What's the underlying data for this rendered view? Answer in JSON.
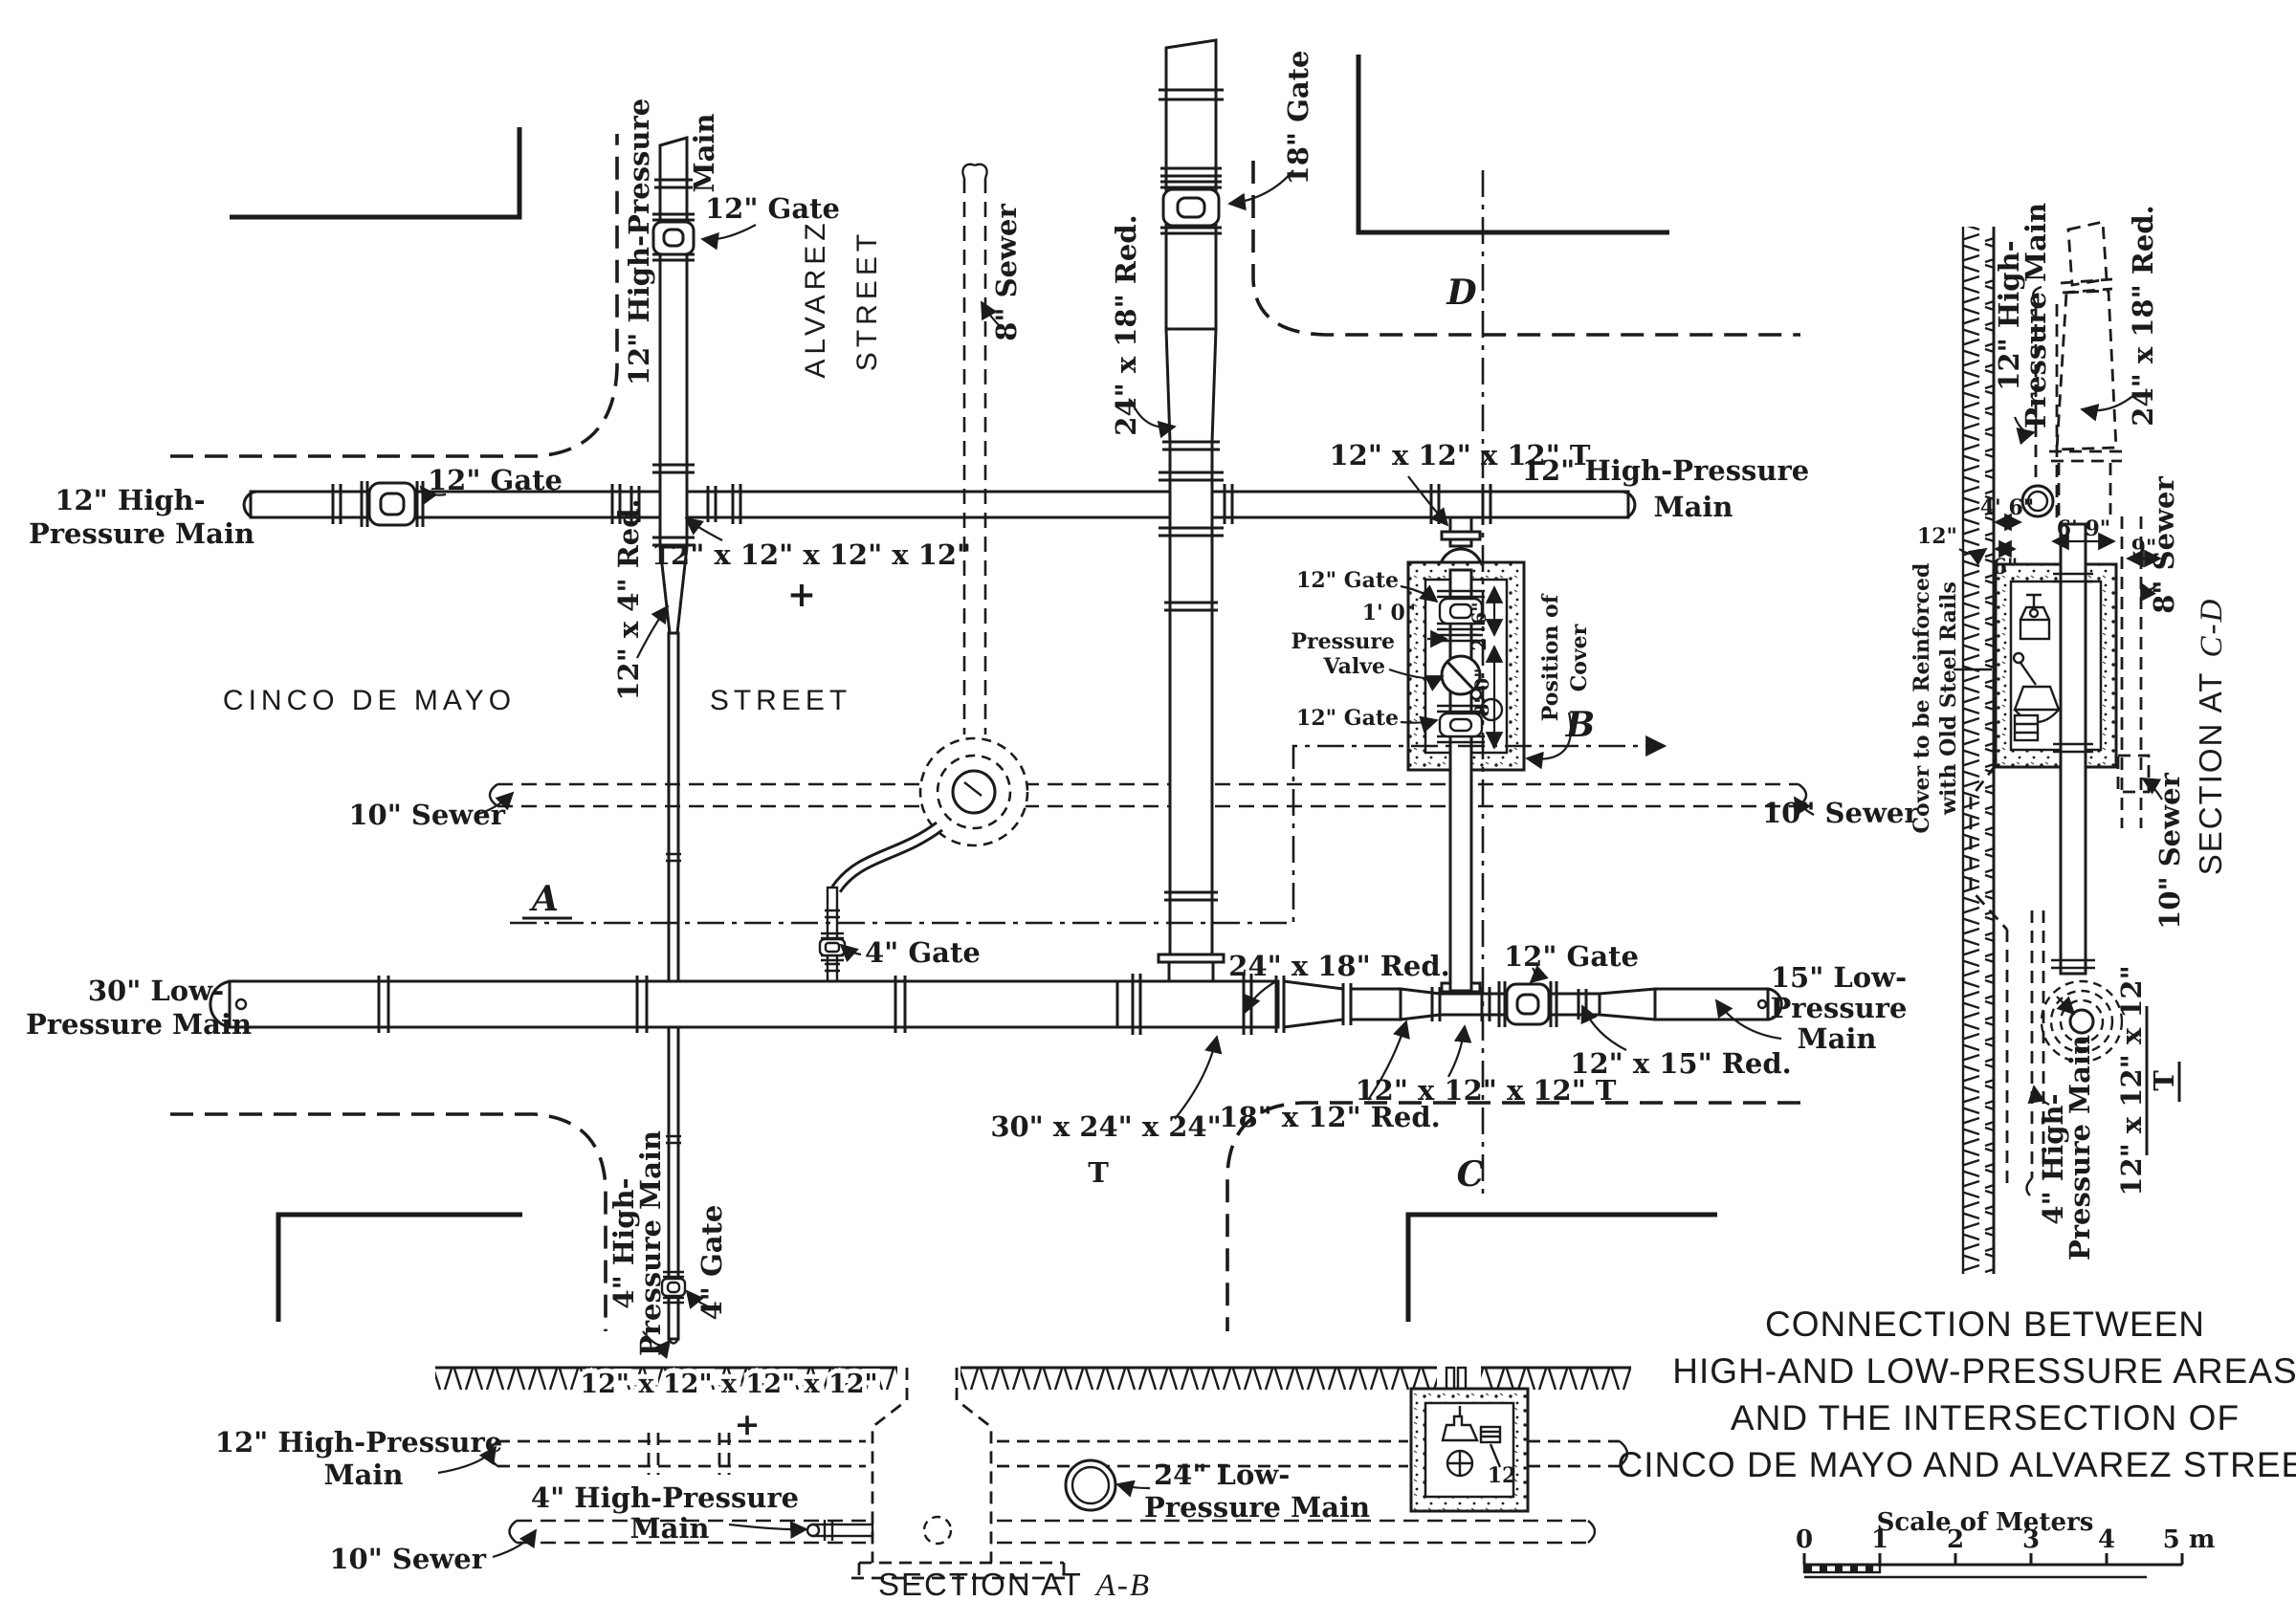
{
  "ink": "#1b1b1b",
  "paper": "#ffffff",
  "plan": {
    "streets": {
      "cinco_de_mayo": "CINCO DE MAYO",
      "street_h": "STREET",
      "alvarez": "ALVAREZ",
      "street_v": "STREET"
    },
    "labels": {
      "hp12_alvarez_1": "12\" High-Pressure",
      "hp12_alvarez_2": "Main",
      "gate12_top": "12\" Gate",
      "sewer8": "8\" Sewer",
      "gate18": "18\" Gate",
      "red24x18_top": "24\" x 18\" Red.",
      "tee12_top": "12\" x 12\" x 12\" T",
      "hp12_right_1": "12\" High-Pressure",
      "hp12_right_2": "Main",
      "hp12_left_1": "12\" High-",
      "hp12_left_2": "Pressure Main",
      "gate12_left": "12\" Gate",
      "cross12": "12\" x 12\" x 12\" x 12\"",
      "cross12_plus": "+",
      "red12x4": "12\" x 4\" Red.",
      "gate12_box_top": "12\" Gate",
      "dim_1_0": "1' 0\"",
      "pressure_valve_1": "Pressure",
      "pressure_valve_2": "Valve",
      "dim_2_6": "2' 6\"",
      "dim_8_0": "8' 0\"",
      "gate12_box_bottom": "12\" Gate",
      "position_of_cover_1": "Position of",
      "position_of_cover_2": "Cover",
      "sewer10_left": "10\" Sewer",
      "sewer10_right": "10\" Sewer",
      "gate4_mid": "4\" Gate",
      "lp30_1": "30\" Low-",
      "lp30_2": "Pressure Main",
      "red24x18_low": "24\" x 18\" Red.",
      "gate12_low": "12\" Gate",
      "lp15_1": "15\" Low-",
      "lp15_2": "Pressure",
      "lp15_3": "Main",
      "tee30_1": "30\" x 24\" x 24\"",
      "tee30_2": "T",
      "red18x12": "18\" x 12\" Red.",
      "tee12_low": "12\" x 12\" x 12\" T",
      "red12x15": "12\" x 15\" Red.",
      "hp4_1": "4\" High-",
      "hp4_2": "Pressure Main",
      "gate4_bottom": "4\" Gate",
      "sec_a": "A",
      "sec_b": "B",
      "sec_c": "C",
      "sec_d": "D"
    }
  },
  "section_ab": {
    "cross": "12\" x 12\" x 12\" x 12\"",
    "plus": "+",
    "hp12_1": "12\" High-Pressure",
    "hp12_2": "Main",
    "hp4_1": "4\" High-Pressure",
    "hp4_2": "Main",
    "sewer10": "10\" Sewer",
    "lp24_1": "24\" Low-",
    "lp24_2": "Pressure Main",
    "valve_size": "12",
    "title_prefix": "SECTION AT",
    "title_suffix": "A-B"
  },
  "section_cd": {
    "hp12_1": "12\" High-",
    "hp12_2": "Pressure Main",
    "red24x18": "24\" x 18\" Red.",
    "sewer8": "8\" Sewer",
    "dim12": "12\"",
    "dim4_6": "4' 6\"",
    "dim6": "6\"",
    "dim6_9": "6' 9\"",
    "dim9": "9\"",
    "cover_1": "Cover to be Reinforced",
    "cover_2": "with Old Steel Rails",
    "sewer10": "10\" Sewer",
    "tee12_1": "12\" x 12\" x 12\"",
    "tee12_2": "T",
    "hp4_1": "4\" High-",
    "hp4_2": "Pressure Main",
    "title_prefix": "SECTION AT",
    "title_suffix": "C-D"
  },
  "title_block": {
    "line1": "CONNECTION BETWEEN",
    "line2": "HIGH-AND LOW-PRESSURE AREAS",
    "line3": "AND THE INTERSECTION OF",
    "line4": "CINCO DE MAYO AND ALVAREZ STREETS",
    "scale_label": "Scale of Meters",
    "ticks": [
      "0",
      "1",
      "2",
      "3",
      "4",
      "5 m"
    ]
  }
}
